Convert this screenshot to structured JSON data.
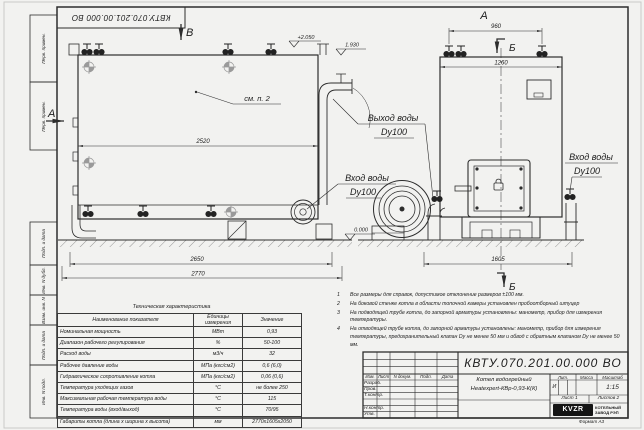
{
  "sheet": {
    "format_note": "Формат А3"
  },
  "corner_stamp": {
    "text": "КВТУ.070.201.00.000 ВО"
  },
  "margin": {
    "labels": [
      "Перв. примен.",
      "Перв. примен.",
      "Подп. и дата",
      "Инв. N дубл.",
      "Взам. инв. N",
      "Подп. и дата",
      "Инв. N подл."
    ]
  },
  "drawing": {
    "view_marker_b": "В",
    "view_marker_a_side": "А",
    "view_marker_a_front": "А",
    "section_b_top": "Б",
    "section_b_bottom": "Б",
    "note_ref": "см. п. 2",
    "outlet_line1": "Выход воды",
    "outlet_line2": "Dy100",
    "inlet_front_line1": "Вход воды",
    "inlet_front_line2": "Dy100",
    "inlet_right_line1": "Вход воды",
    "inlet_right_line2": "Dy100",
    "elev_plus2050": "+2.050",
    "elev_1930": "1.930",
    "elev_0000": "0.000",
    "dim_2520": "2520",
    "dim_2650": "2650",
    "dim_2770": "2770",
    "dim_960": "960",
    "dim_1260": "1260",
    "dim_1605": "1605"
  },
  "notes": {
    "items": [
      {
        "num": "1",
        "text": "Все размеры для справок, допустимое отклонение размеров ±100 мм."
      },
      {
        "num": "2",
        "text": "На боковой стенке котла в области топочной камеры установлен пробоотборный штуцер"
      },
      {
        "num": "3",
        "text": "На подводящей трубе котла, до запорной арматуры установлены: манометр, прибор для измерения температуры."
      },
      {
        "num": "4",
        "text": "На отводящей трубе котла, до запорной арматуры установлены: манометр, прибор для измерения температуры, предохранительный клапан Dу не менее 50 мм и обвод с обратным клапаном Dу не менее 50 мм."
      }
    ]
  },
  "spec_table": {
    "title": "Техническая характеристика",
    "col_name": "Наименование показателя",
    "col_units": "Единицы измерения",
    "col_value": "Значение",
    "rows": [
      {
        "name": "Номинальная мощность",
        "units": "МВт",
        "value": "0,93"
      },
      {
        "name": "Диапазон рабочего регулирования",
        "units": "%",
        "value": "50-100"
      },
      {
        "name": "Расход воды",
        "units": "м3/ч",
        "value": "32"
      },
      {
        "name": "Рабочее давление воды",
        "units": "МПа (кгс/см2)",
        "value": "0,6 (6,0)"
      },
      {
        "name": "Гидравлическое сопротивление котла",
        "units": "МПа (кгс/см2)",
        "value": "0,06 (0,6)"
      },
      {
        "name": "Температура уходящих газов",
        "units": "°С",
        "value": "не более 250"
      },
      {
        "name": "Максимальная рабочая температура воды",
        "units": "°С",
        "value": "115"
      },
      {
        "name": "Температура воды (вход/выход)",
        "units": "°С",
        "value": "70/95"
      },
      {
        "name": "Габариты котла (длина х ширина х высота)",
        "units": "мм",
        "value": "2770х1605х2050"
      }
    ]
  },
  "title_block": {
    "doc_number": "КВТУ.070.201.00.000 ВО",
    "name_line1": "Котел водогрейный",
    "name_line2": "Heatexpert-КВр-0,93-К(К)",
    "col_izm": "Изм.",
    "col_list": "Лист",
    "col_doc": "N докум.",
    "col_sign": "Подп.",
    "col_date": "Дата",
    "role_developer": "Разраб.",
    "role_checker": "Пров.",
    "role_tcontrol": "Т.контр.",
    "role_ncontrol": "Н.контр.",
    "role_approver": "Утв.",
    "lit_header": "Лит.",
    "mass_header": "Масса",
    "scale_header": "Масштаб",
    "lit_value": "И",
    "scale_value": "1:15",
    "sheet_info": "Лист 1",
    "sheets_info": "Листов 2",
    "logo": "KVZR",
    "logo_caption1": "КОТЕЛЬНЫЙ",
    "logo_caption2": "ЗАВОД РЭП"
  }
}
